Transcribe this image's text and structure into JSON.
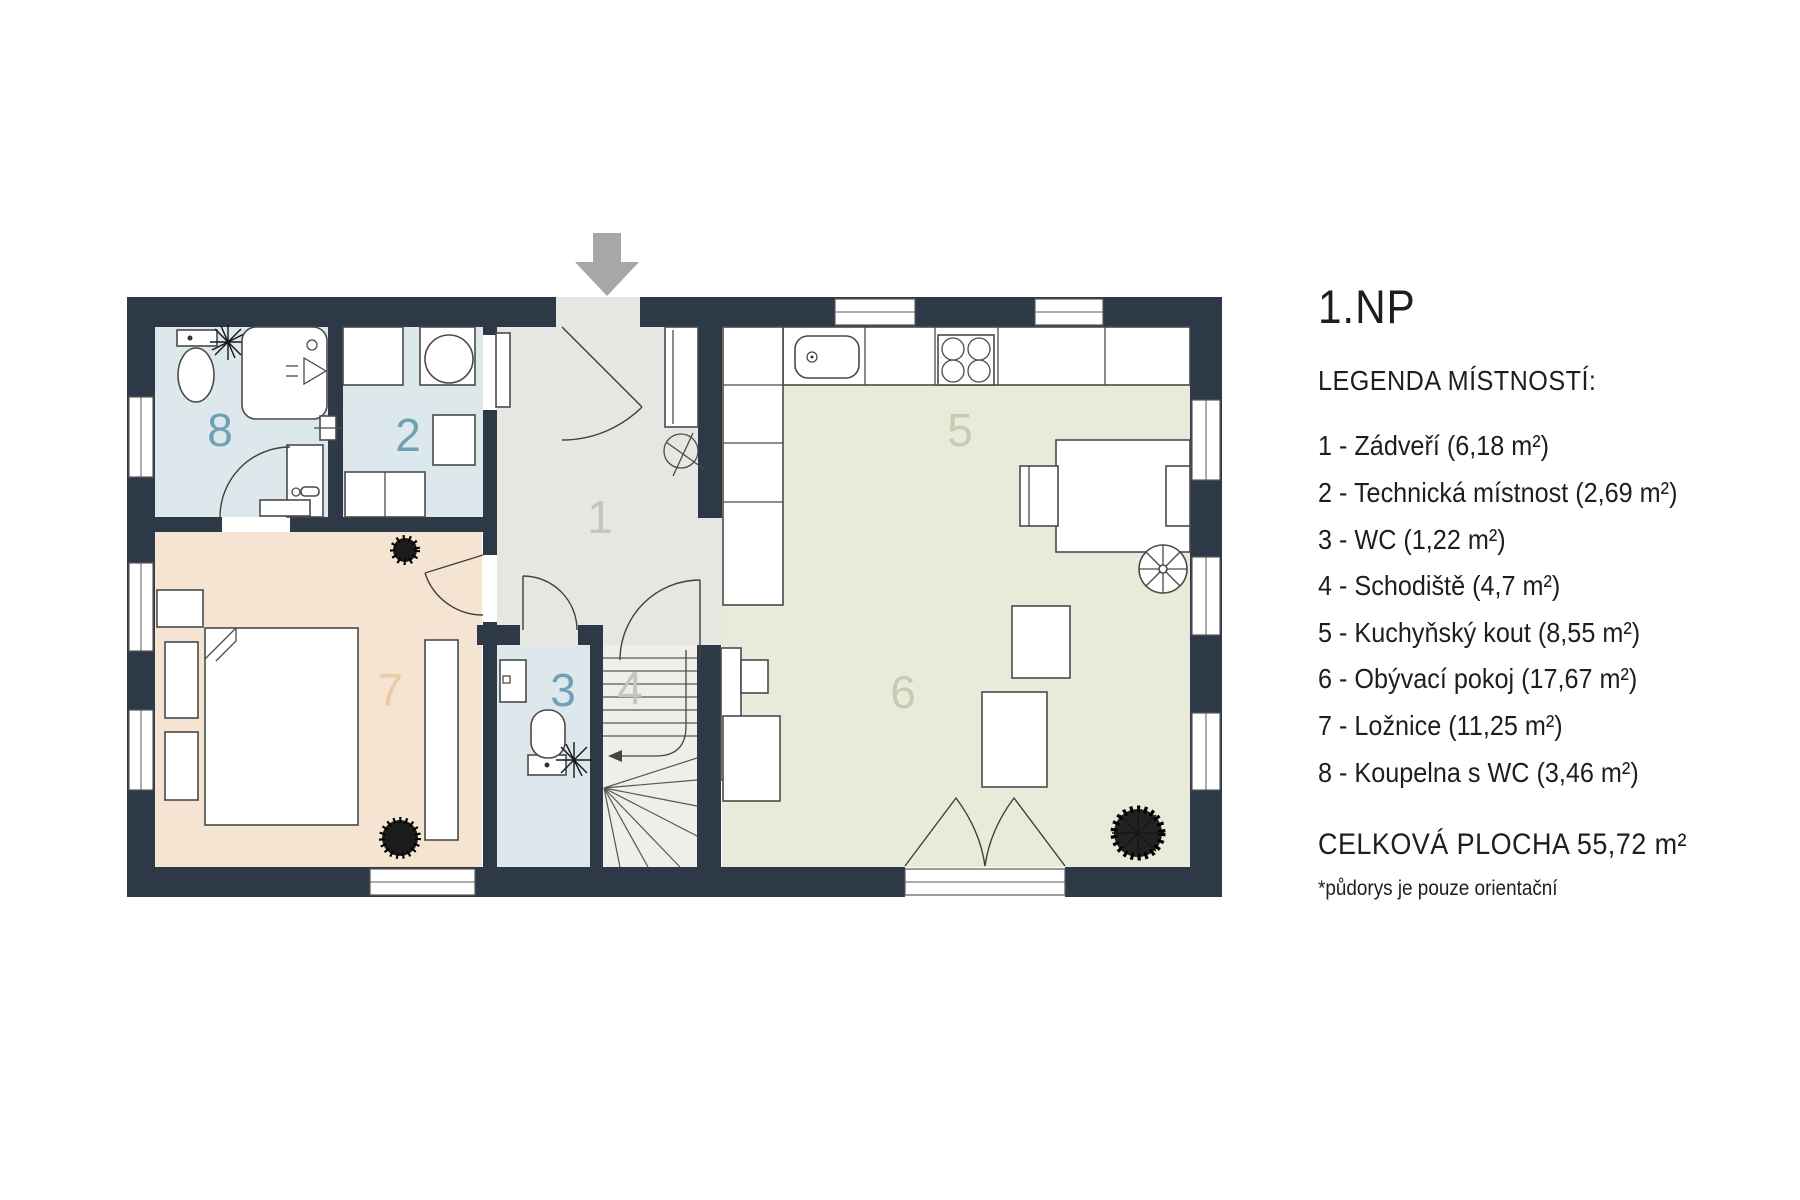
{
  "plan_title": "1.NP",
  "legend": {
    "heading": "LEGENDA MÍSTNOSTÍ:",
    "items": [
      {
        "text": "1 - Zádveří (6,18 m²)"
      },
      {
        "text": "2 - Technická místnost (2,69 m²)"
      },
      {
        "text": "3 - WC (1,22 m²)"
      },
      {
        "text": "4 - Schodiště (4,7 m²)"
      },
      {
        "text": "5 - Kuchyňský kout (8,55 m²)"
      },
      {
        "text": "6 - Obývací pokoj (17,67 m²)"
      },
      {
        "text": "7 - Ložnice (11,25 m²)"
      },
      {
        "text": "8 - Koupelna s WC (3,46 m²)"
      }
    ],
    "total": "CELKOVÁ PLOCHA 55,72 m²",
    "note": "*půdorys je pouze orientační"
  },
  "rooms": [
    {
      "number": "1",
      "name": "Zádveří",
      "area": "6,18 m²"
    },
    {
      "number": "2",
      "name": "Technická místnost",
      "area": "2,69 m²"
    },
    {
      "number": "3",
      "name": "WC",
      "area": "1,22 m²"
    },
    {
      "number": "4",
      "name": "Schodiště",
      "area": "4,7 m²"
    },
    {
      "number": "5",
      "name": "Kuchyňský kout",
      "area": "8,55 m²"
    },
    {
      "number": "6",
      "name": "Obývací pokoj",
      "area": "17,67 m²"
    },
    {
      "number": "7",
      "name": "Ložnice",
      "area": "11,25 m²"
    },
    {
      "number": "8",
      "name": "Koupelna s WC",
      "area": "3,46 m²"
    }
  ],
  "colors": {
    "wall": "#2d3947",
    "room_blue": "#dde8ec",
    "room_gray": "#e7e6e2",
    "room_peach": "#f5e4d1",
    "room_olive": "#eaeadb",
    "stair_fill": "#efeeeb",
    "label_blue": "#6fa0b4",
    "label_gray": "#c4c4c1",
    "label_olive": "#c8cbb2",
    "label_peach": "#eccaa4",
    "arrow_gray": "#a6a8a7"
  }
}
